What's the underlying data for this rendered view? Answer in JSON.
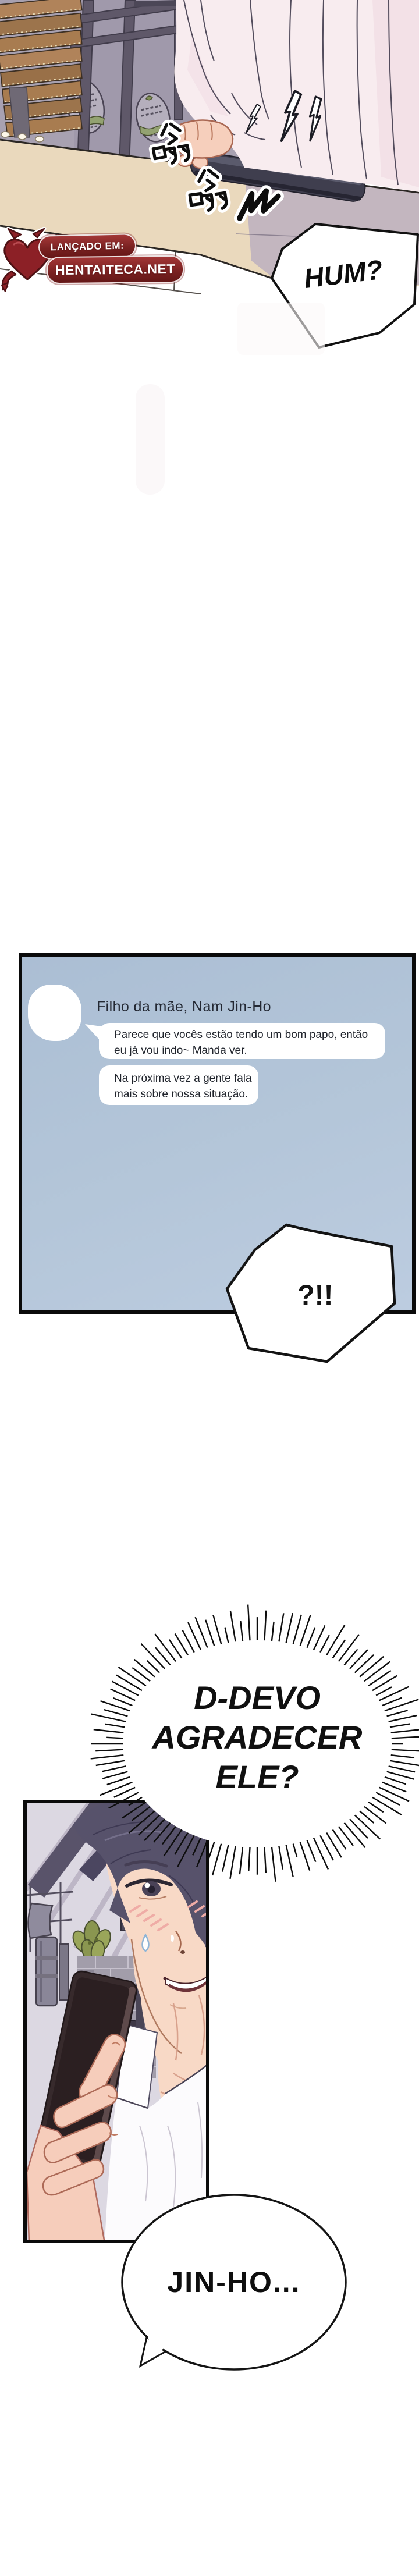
{
  "top_scene": {
    "hum": "HUM?",
    "buzz_sfx": "嗡 嗡",
    "buzz_squiggle_sfx": "ㇺ",
    "watermark": {
      "label1": "LANÇADO EM:",
      "label2": "HENTAITECA.NET"
    }
  },
  "chat": {
    "sender_name": "Filho da mãe, Nam Jin-Ho",
    "messages": [
      {
        "line1": "Parece que vocês estão tendo um bom papo, então",
        "line2": "eu já vou indo~ Manda ver."
      },
      {
        "line1": "Na próxima vez a gente fala",
        "line2": "mais sobre nossa situação."
      }
    ]
  },
  "bubbles": {
    "surprise": "?!!",
    "shout_line1": "D-DEVO",
    "shout_line2": "AGRADECER",
    "shout_line3": "ELE?",
    "jinho": "JIN-HO..."
  },
  "bottom_panel": {
    "sign_text": "SE"
  },
  "colors": {
    "chat_panel_bg": "#b2c4d8",
    "panel_border": "#0b0b0b",
    "watermark_red": "#8c2026",
    "counter_tan": "#ead9bd",
    "counter_shadow_mauve": "#c3b6bf",
    "wall_mauve": "#a8a1b1",
    "wood_brown": "#a87c50",
    "fascia_blue": "#8d96ad",
    "shirt_pink": "#f8ecef",
    "skin": "#f6cfbc",
    "hair": "#57526b"
  }
}
